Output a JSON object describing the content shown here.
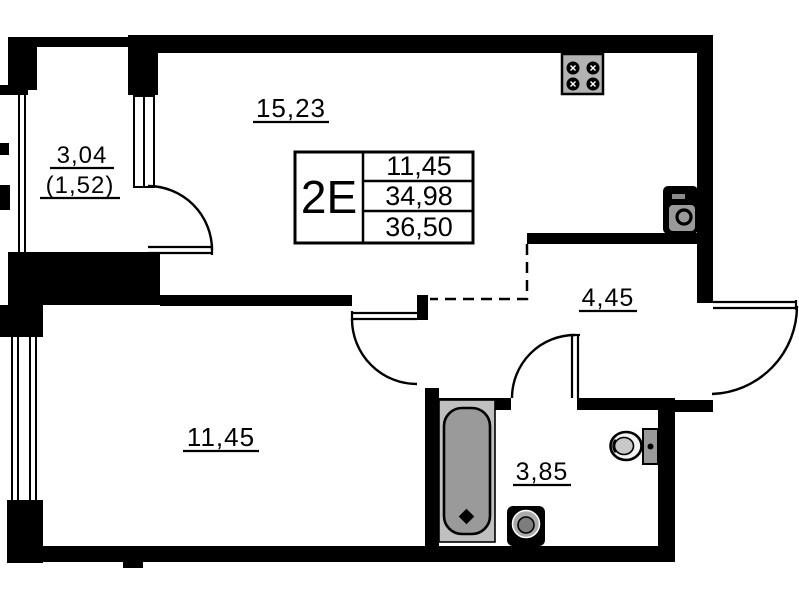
{
  "plan": {
    "title": "apartment floor plan",
    "unit": "2E",
    "labels": {
      "kitchen_living": "15,23",
      "balcony": "3,04",
      "balcony_reduced": "(1,52)",
      "bedroom": "11,45",
      "hallway": "4,45",
      "bathroom": "3,85"
    },
    "info_table": {
      "unit": "2E",
      "rows": [
        "11,45",
        "34,98",
        "36,50"
      ]
    },
    "icons": [
      "stove-icon",
      "kitchen-sink-icon",
      "bathtub-icon",
      "bathroom-sink-icon",
      "toilet-icon"
    ],
    "colors": {
      "wall": "#000000",
      "background": "#ffffff",
      "fixture_light": "#bdbdbd",
      "fixture_mid": "#9a9a9a",
      "fixture_dark": "#777777"
    }
  }
}
